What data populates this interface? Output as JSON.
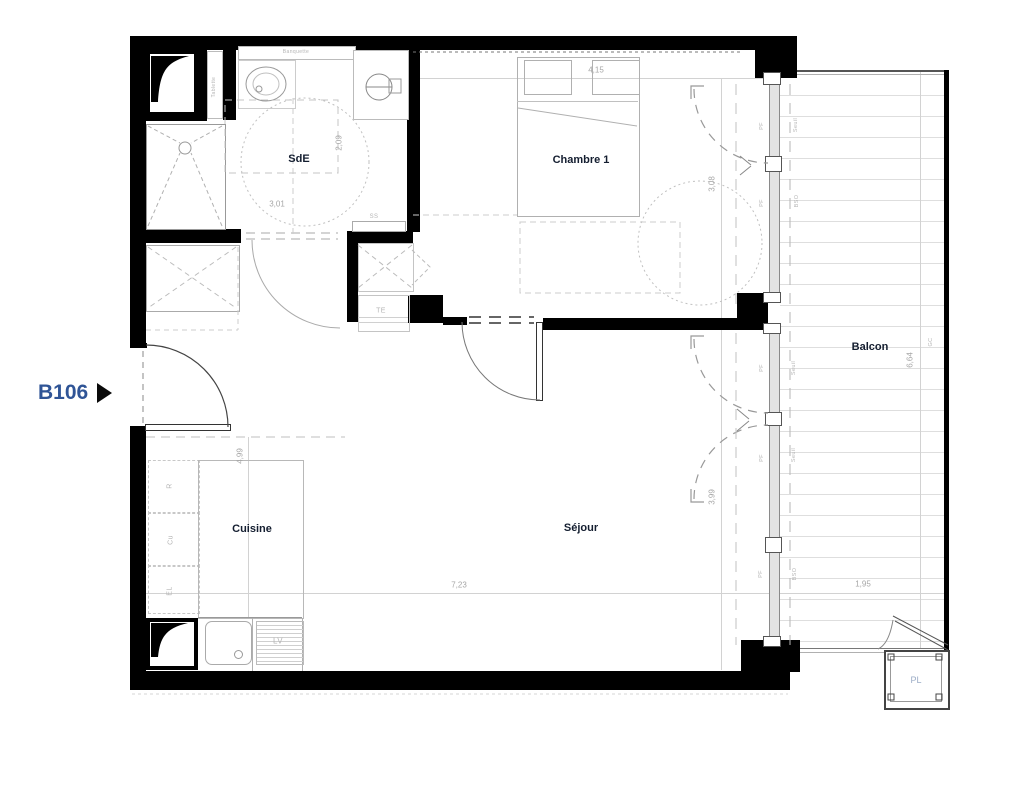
{
  "unit": {
    "label": "B106"
  },
  "rooms": [
    {
      "name": "room-label-sde",
      "text": "SdE",
      "x": 299,
      "y": 159
    },
    {
      "name": "room-label-chambre-1",
      "text": "Chambre 1",
      "x": 581,
      "y": 160
    },
    {
      "name": "room-label-balcon",
      "text": "Balcon",
      "x": 870,
      "y": 347
    },
    {
      "name": "room-label-cuisine",
      "text": "Cuisine",
      "x": 252,
      "y": 529
    },
    {
      "name": "room-label-sejour",
      "text": "Séjour",
      "x": 581,
      "y": 528
    },
    {
      "name": "room-label-pl",
      "text": "PL",
      "x": 916,
      "y": 680,
      "cls": "pl"
    }
  ],
  "dimensions": [
    {
      "name": "dim-4-15",
      "text": "4,15",
      "x": 596,
      "y": 70,
      "v": false
    },
    {
      "name": "dim-3-08",
      "text": "3,08",
      "x": 712,
      "y": 184,
      "v": true
    },
    {
      "name": "dim-2-09",
      "text": "2,09",
      "x": 339,
      "y": 143,
      "v": true
    },
    {
      "name": "dim-3-01",
      "text": "3,01",
      "x": 277,
      "y": 204,
      "v": false
    },
    {
      "name": "dim-4-99",
      "text": "4,99",
      "x": 240,
      "y": 456,
      "v": true
    },
    {
      "name": "dim-7-23",
      "text": "7,23",
      "x": 459,
      "y": 585,
      "v": false
    },
    {
      "name": "dim-3-99",
      "text": "3,99",
      "x": 712,
      "y": 497,
      "v": true
    },
    {
      "name": "dim-6-64",
      "text": "6,64",
      "x": 910,
      "y": 360,
      "v": true
    },
    {
      "name": "dim-1-95",
      "text": "1,95",
      "x": 863,
      "y": 584,
      "v": false
    }
  ],
  "annotations": [
    {
      "name": "label-banquette",
      "text": "Banquette",
      "x": 296,
      "y": 52,
      "v": false,
      "fs": 5
    },
    {
      "name": "label-tablette",
      "text": "Tablette",
      "x": 214,
      "y": 87,
      "v": true,
      "fs": 5
    },
    {
      "name": "label-ss",
      "text": "SS",
      "x": 374,
      "y": 217,
      "v": false,
      "fs": 6
    },
    {
      "name": "label-te",
      "text": "TE",
      "x": 381,
      "y": 311,
      "v": false,
      "fs": 7
    },
    {
      "name": "label-lv",
      "text": "LV",
      "x": 278,
      "y": 641,
      "v": false,
      "fs": 8
    },
    {
      "name": "label-r",
      "text": "R",
      "x": 170,
      "y": 486,
      "v": true,
      "fs": 7
    },
    {
      "name": "label-cu",
      "text": "Cu",
      "x": 171,
      "y": 540,
      "v": true,
      "fs": 7
    },
    {
      "name": "label-el",
      "text": "EL",
      "x": 170,
      "y": 591,
      "v": true,
      "fs": 7
    },
    {
      "name": "label-pf-chambre-1",
      "text": "PF",
      "x": 762,
      "y": 126,
      "v": true,
      "fs": 5.5
    },
    {
      "name": "label-pf-chambre-2",
      "text": "PF",
      "x": 762,
      "y": 203,
      "v": true,
      "fs": 5.5
    },
    {
      "name": "label-pf-sejour-1",
      "text": "PF",
      "x": 762,
      "y": 368,
      "v": true,
      "fs": 5.5
    },
    {
      "name": "label-pf-sejour-2",
      "text": "PF",
      "x": 762,
      "y": 458,
      "v": true,
      "fs": 5.5
    },
    {
      "name": "label-pf-sejour-3",
      "text": "PF",
      "x": 761,
      "y": 574,
      "v": true,
      "fs": 5.5
    },
    {
      "name": "label-seuil-1",
      "text": "Seuil",
      "x": 796,
      "y": 125,
      "v": true,
      "fs": 5.5
    },
    {
      "name": "label-seuil-2",
      "text": "Seuil",
      "x": 794,
      "y": 368,
      "v": true,
      "fs": 5.5
    },
    {
      "name": "label-seuil-3",
      "text": "Seuil",
      "x": 794,
      "y": 455,
      "v": true,
      "fs": 5.5
    },
    {
      "name": "label-bso-1",
      "text": "BSO",
      "x": 797,
      "y": 201,
      "v": true,
      "fs": 5.5
    },
    {
      "name": "label-bso-2",
      "text": "BSO",
      "x": 795,
      "y": 574,
      "v": true,
      "fs": 5.5
    },
    {
      "name": "label-gc",
      "text": "GC",
      "x": 931,
      "y": 342,
      "v": true,
      "fs": 5.5
    }
  ],
  "colors": {
    "wall": "#000000",
    "unit_label": "#2f5496",
    "room_label": "#141e30",
    "dim_text": "#a6a6a6",
    "tiny_text": "#b5b5b5",
    "pl_text": "#9bacc6",
    "fixture_line": "#9c9c9c",
    "deck_line": "#dedede"
  }
}
